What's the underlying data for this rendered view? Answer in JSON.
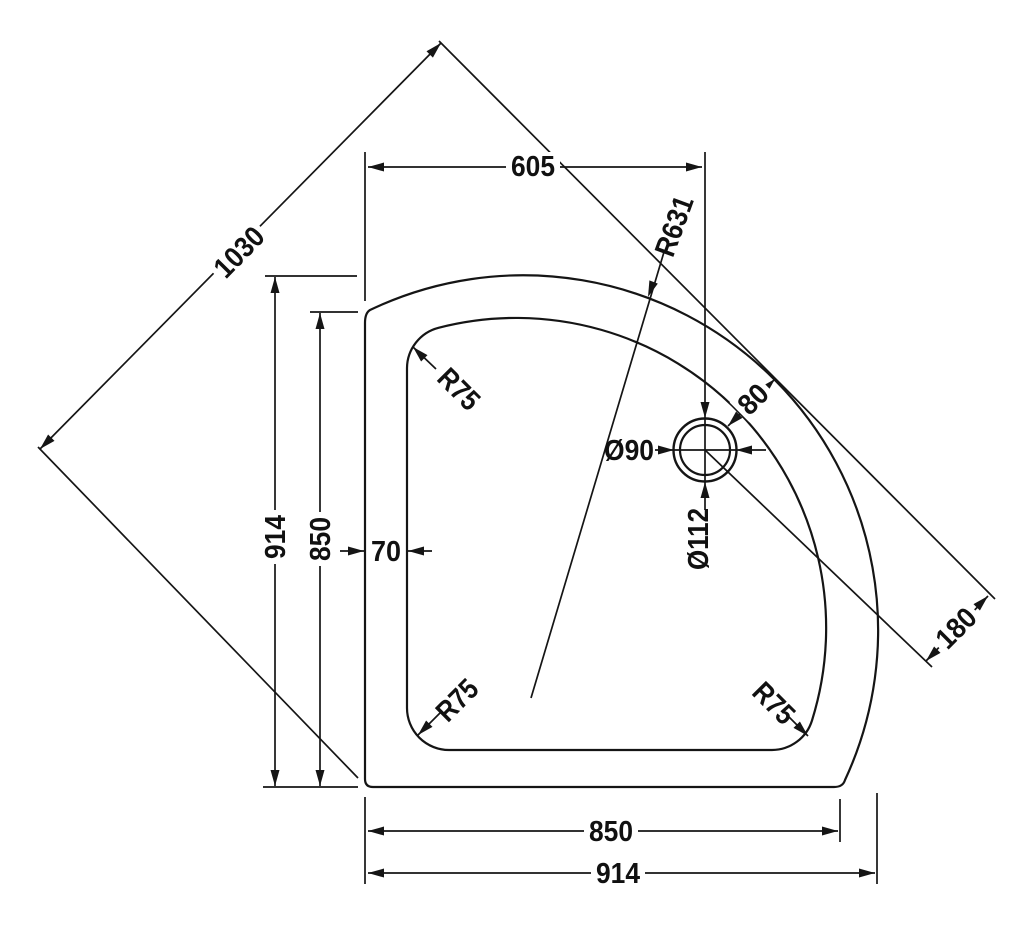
{
  "drawing": {
    "type": "technical-dimension-drawing",
    "subject": "offset quadrant shower tray plan view",
    "units": "mm",
    "colors": {
      "line": "#151515",
      "background": "#ffffff"
    },
    "dimensions": {
      "top_width": "605",
      "diagonal": "1030",
      "front_edge_radius": "R631",
      "corner_radius_top_left": "R75",
      "corner_radius_bottom_left": "R75",
      "corner_radius_bottom_right": "R75",
      "waste_hole_diameter": "Ø90",
      "waste_flange_diameter": "Ø112",
      "waste_edge_gap": "80",
      "waste_diagonal_offset": "180",
      "overall_depth": "914",
      "inner_depth": "850",
      "rim_width": "70",
      "inner_width": "850",
      "overall_width": "914"
    }
  }
}
